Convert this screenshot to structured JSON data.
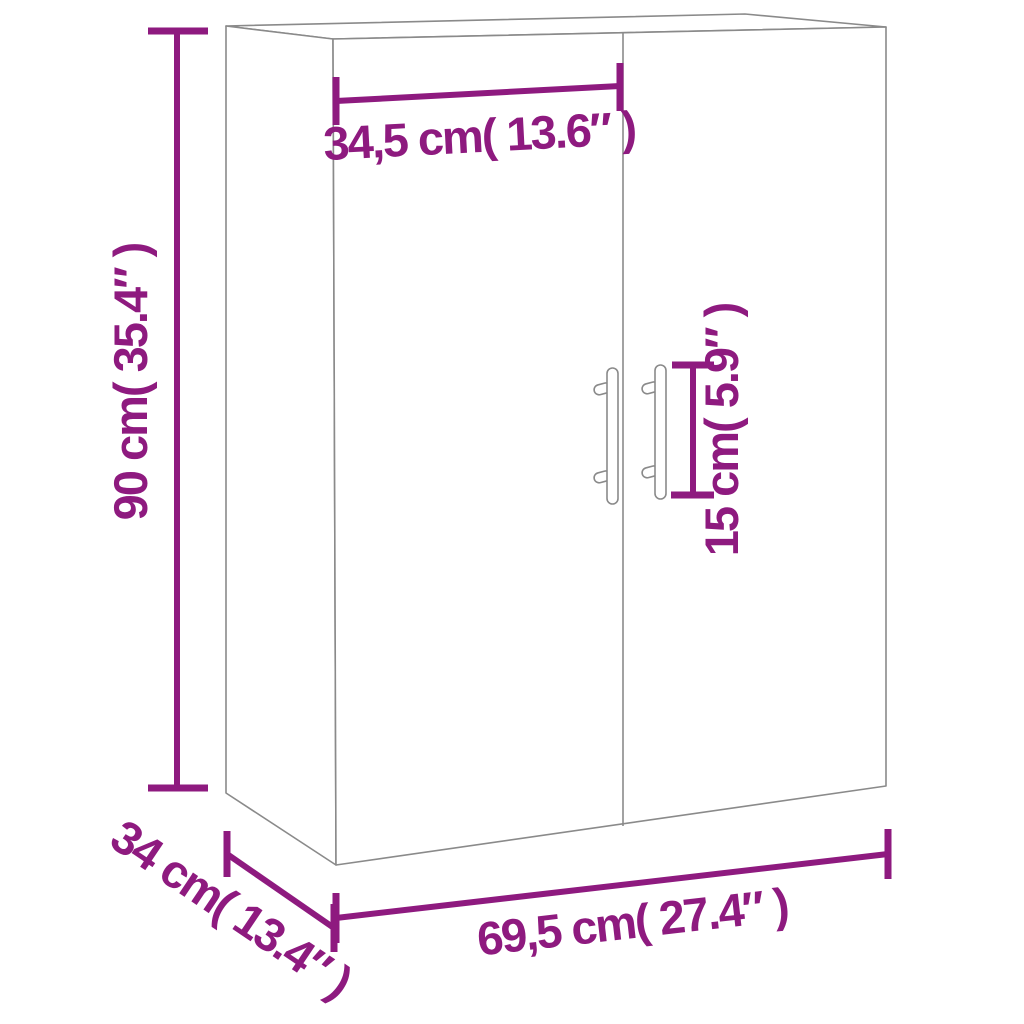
{
  "colors": {
    "background": "#ffffff",
    "cabinet_outline": "#8a8a8a",
    "dimension_accent": "#8E1A7F"
  },
  "dimensions": {
    "door_width": "34,5 cm( 13.6″ )",
    "height": "90 cm( 35.4″ )",
    "handle_height": "15 cm( 5.9″ )",
    "depth": "34 cm( 13.4″ )",
    "width": "69,5 cm( 27.4″ )"
  }
}
